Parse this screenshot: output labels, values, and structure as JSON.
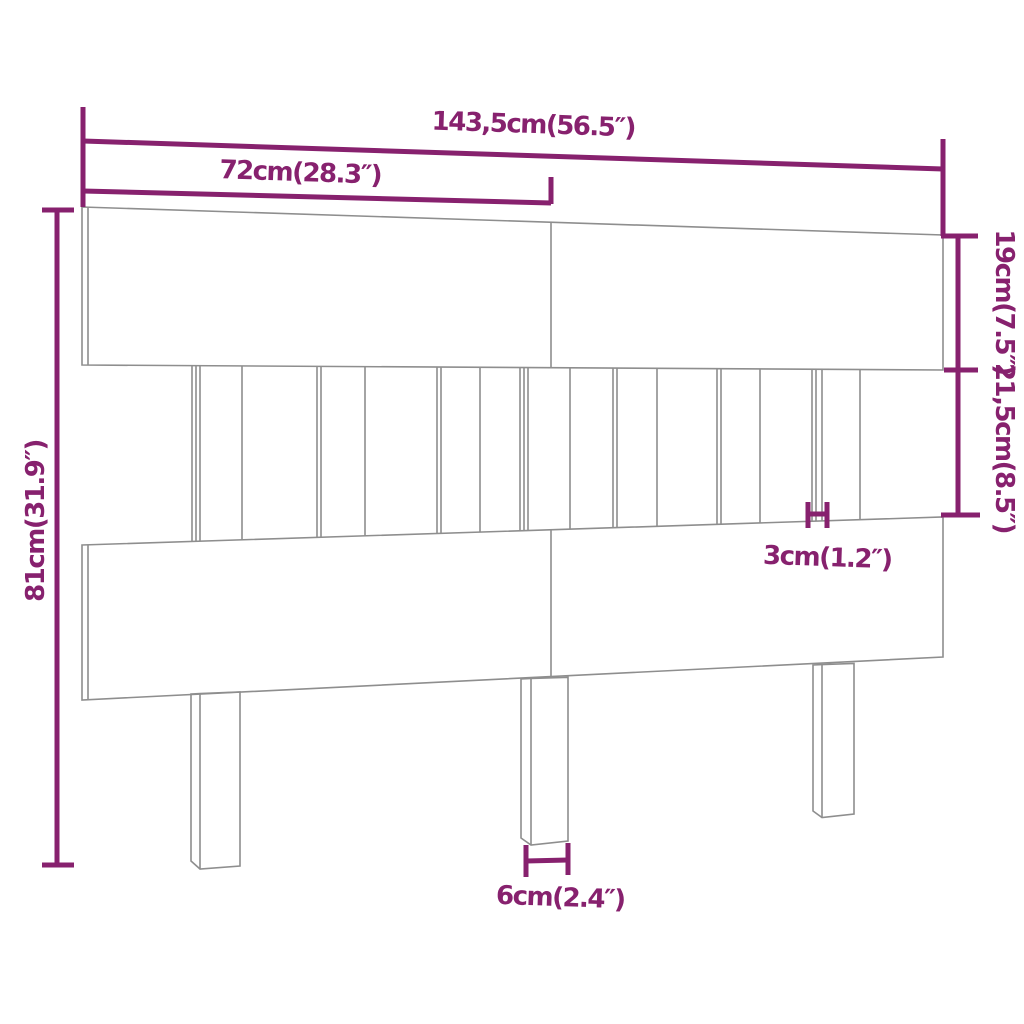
{
  "colors": {
    "accent": "#87216E",
    "line": "#8E8E8E",
    "bg": "#FFFFFF"
  },
  "diagram": {
    "type": "product-dimension-diagram",
    "product": "slatted headboard with legs",
    "labels": {
      "total_width": "143,5cm(56.5″)",
      "panel_width": "72cm(28.3″)",
      "total_height": "81cm(31.9″)",
      "top_board_height": "19cm(7.5″)",
      "slat_section_height": "21,5cm(8.5″)",
      "slat_thickness": "3cm(1.2″)",
      "leg_width": "6cm(2.4″)"
    },
    "measurements": [
      {
        "name": "total width",
        "cm": "143,5",
        "inches": "56.5"
      },
      {
        "name": "panel width",
        "cm": "72",
        "inches": "28.3"
      },
      {
        "name": "total height",
        "cm": "81",
        "inches": "31.9"
      },
      {
        "name": "top board height",
        "cm": "19",
        "inches": "7.5"
      },
      {
        "name": "slat section height",
        "cm": "21,5",
        "inches": "8.5"
      },
      {
        "name": "slat thickness",
        "cm": "3",
        "inches": "1.2"
      },
      {
        "name": "leg width",
        "cm": "6",
        "inches": "2.4"
      }
    ]
  }
}
